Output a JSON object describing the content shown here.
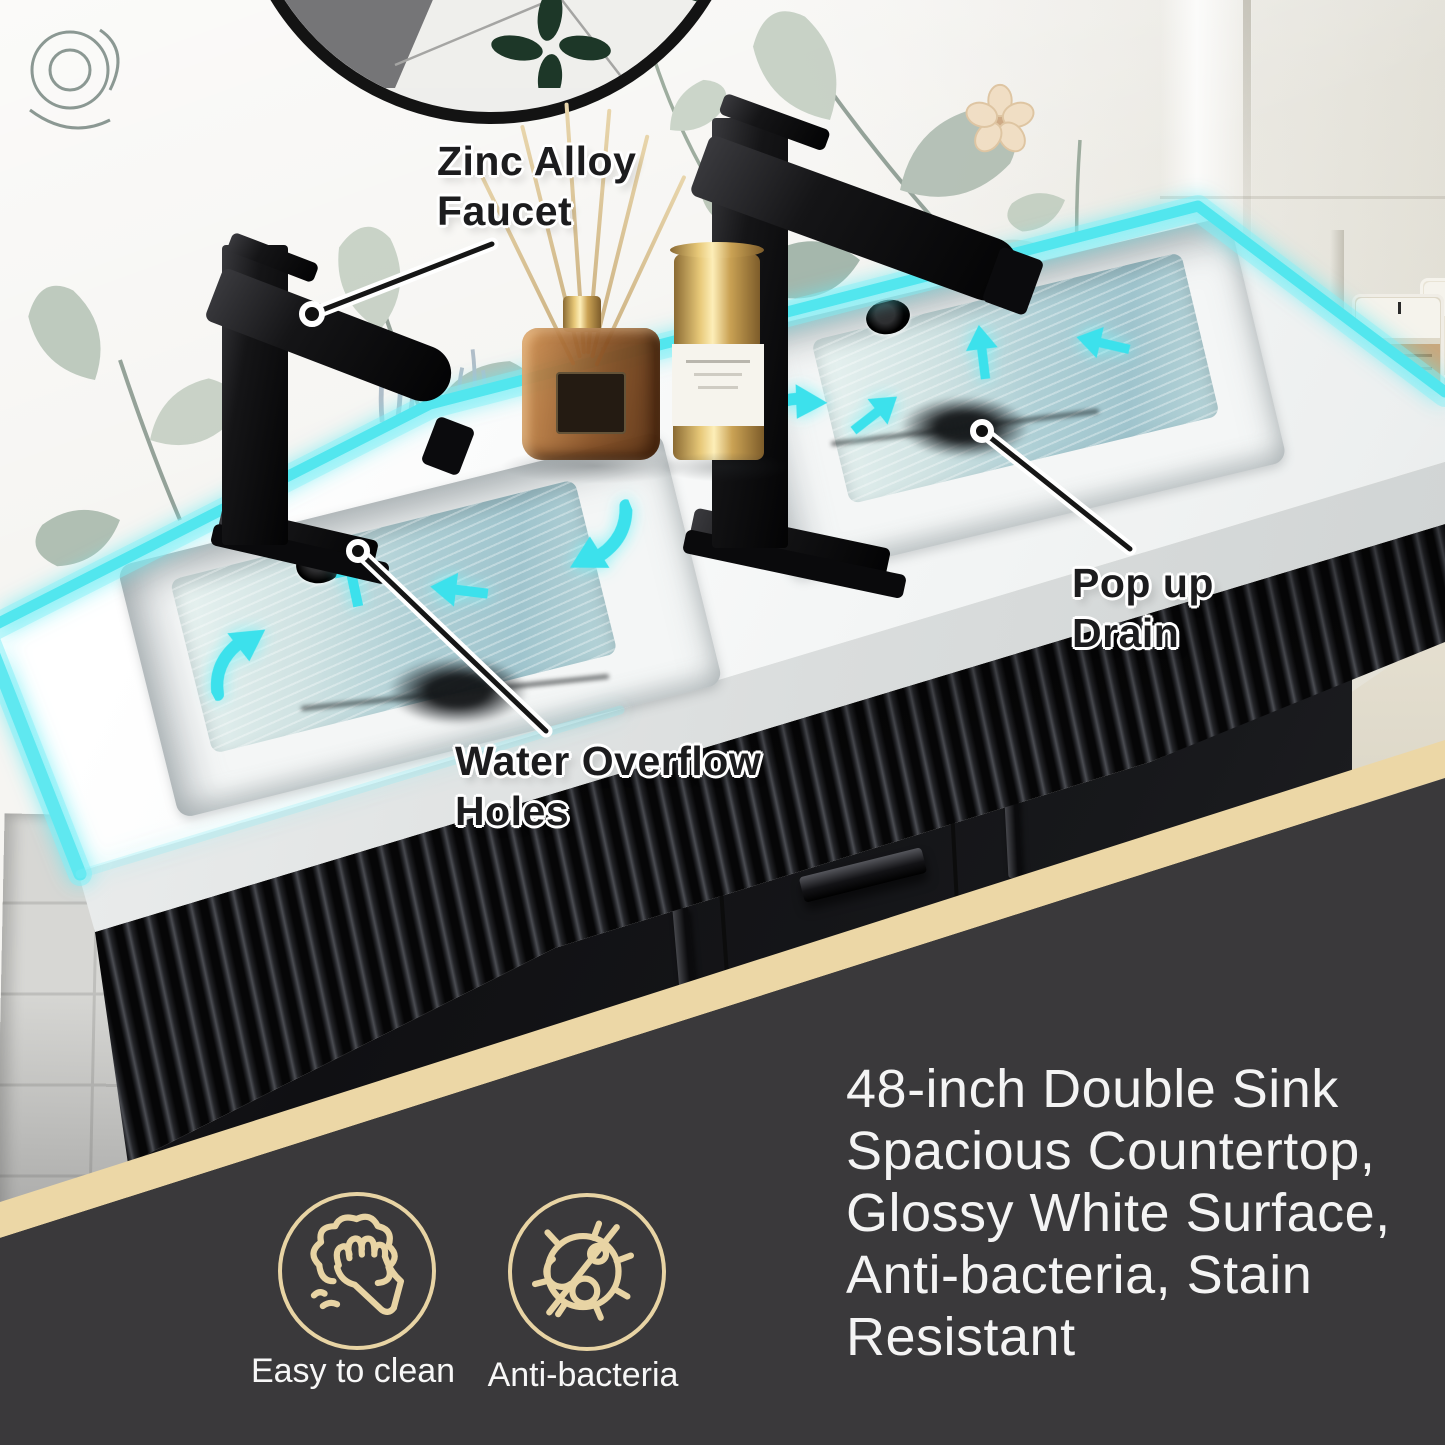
{
  "callouts": {
    "faucet": {
      "lines": [
        "Zinc Alloy",
        "Faucet"
      ]
    },
    "overflow": {
      "lines": [
        "Water Overflow",
        "Holes"
      ]
    },
    "drain": {
      "lines": [
        "Pop up",
        "Drain"
      ]
    }
  },
  "features": {
    "lines": [
      "48-inch Double Sink",
      "Spacious Countertop,",
      "Glossy White Surface,",
      "Anti-bacteria, Stain",
      "Resistant"
    ]
  },
  "badges": [
    {
      "icon": "easy-clean-icon",
      "label": "Easy to clean"
    },
    {
      "icon": "anti-bacteria-icon",
      "label": "Anti-bacteria"
    }
  ],
  "colors": {
    "accent_cyan": "#3ce1ec",
    "band_beige": "#ecd7a6",
    "panel_dark": "#3a393b",
    "icon_line": "#e8d4a4",
    "callout_ink": "#1c1c1e",
    "light_text": "#f4f4f4"
  }
}
